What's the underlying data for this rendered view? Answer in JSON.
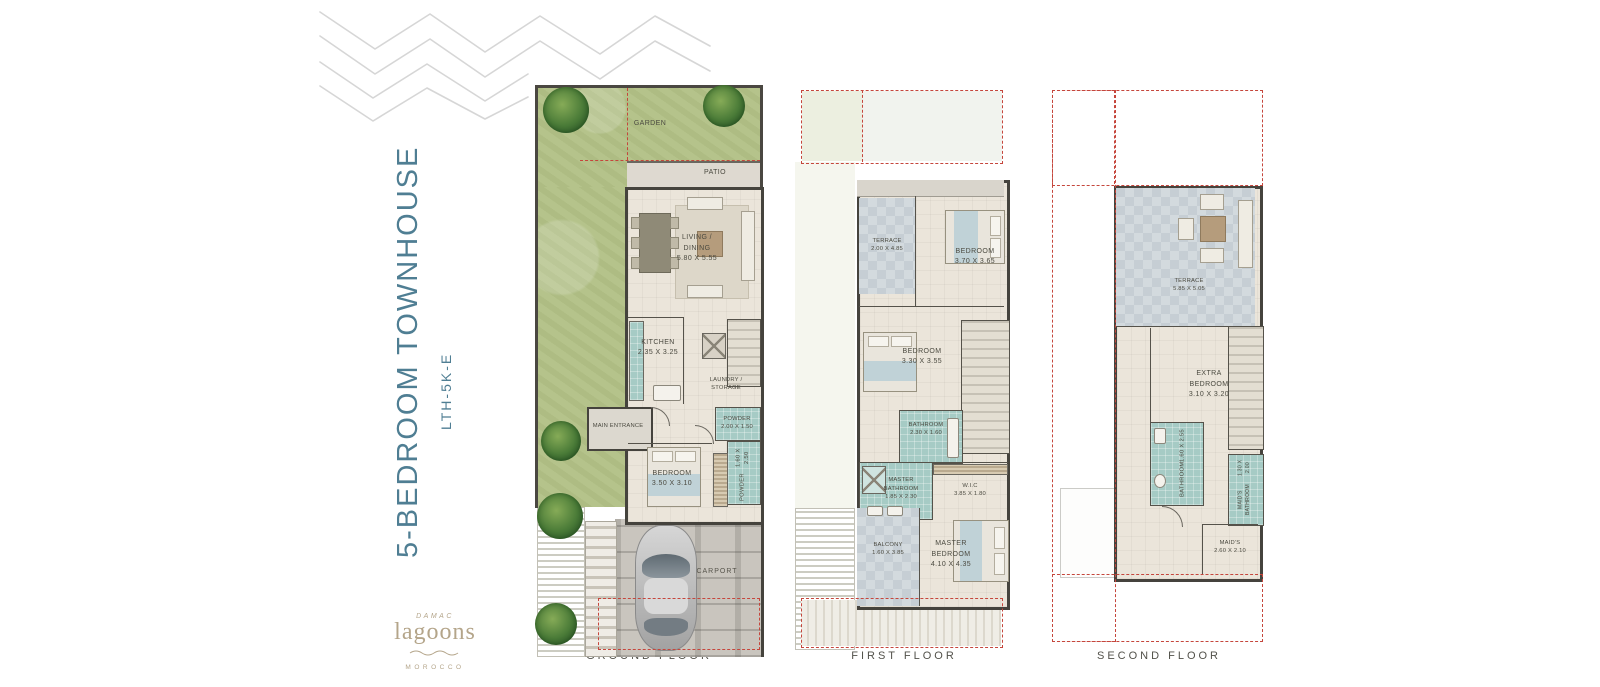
{
  "title": {
    "main": "5-BEDROOM TOWNHOUSE",
    "code": "LTH-5K-E"
  },
  "logo": {
    "brand": "DAMAC",
    "name": "lagoons",
    "region": "MOROCCO"
  },
  "icons": {
    "waves": "zigzag-wave-lines",
    "tree": "tree-top-view",
    "car": "car-top-view"
  },
  "colors": {
    "accent_blue": "#4f7e93",
    "logo_beige": "#b4a58a",
    "dashed_red": "#c5463c",
    "bathroom_teal": "#a6cbc5",
    "garden_green": "#b5c38b",
    "wall_dark": "#45433d",
    "label_gray": "#52514a"
  },
  "floors": [
    {
      "label": "GROUND FLOOR",
      "rooms": [
        {
          "name": "GARDEN",
          "dim": ""
        },
        {
          "name": "PATIO",
          "dim": ""
        },
        {
          "name": "LIVING / DINING",
          "dim": "5.80 X 5.55"
        },
        {
          "name": "KITCHEN",
          "dim": "2.35 X 3.25"
        },
        {
          "name": "LAUNDRY / STORAGE",
          "dim": ""
        },
        {
          "name": "MAIN ENTRANCE",
          "dim": ""
        },
        {
          "name": "POWDER",
          "dim": "2.00 X 1.50"
        },
        {
          "name": "BEDROOM",
          "dim": "3.50 X 3.10"
        },
        {
          "name": "POWDER",
          "dim": "1.60 X 2.50"
        },
        {
          "name": "CARPORT",
          "dim": ""
        }
      ]
    },
    {
      "label": "FIRST FLOOR",
      "rooms": [
        {
          "name": "TERRACE",
          "dim": "2.00 X 4.85"
        },
        {
          "name": "BEDROOM",
          "dim": "3.70 X 3.65"
        },
        {
          "name": "BEDROOM",
          "dim": "3.30 X 3.55"
        },
        {
          "name": "BATHROOM",
          "dim": "2.30 X 1.60"
        },
        {
          "name": "MASTER BATHROOM",
          "dim": "1.85 X 2.30"
        },
        {
          "name": "W.I.C",
          "dim": "3.85 X 1.80"
        },
        {
          "name": "BALCONY",
          "dim": "1.60 X 3.85"
        },
        {
          "name": "MASTER BEDROOM",
          "dim": "4.10 X 4.35"
        }
      ]
    },
    {
      "label": "SECOND FLOOR",
      "rooms": [
        {
          "name": "TERRACE",
          "dim": "5.85 X 5.05"
        },
        {
          "name": "EXTRA BEDROOM",
          "dim": "3.10 X 3.20"
        },
        {
          "name": "BATHROOM",
          "dim": "1.60 X 2.55"
        },
        {
          "name": "MAID'S BATHROOM",
          "dim": "1.30 X 2.00"
        },
        {
          "name": "MAID'S",
          "dim": "2.60 X 2.10"
        }
      ]
    }
  ]
}
